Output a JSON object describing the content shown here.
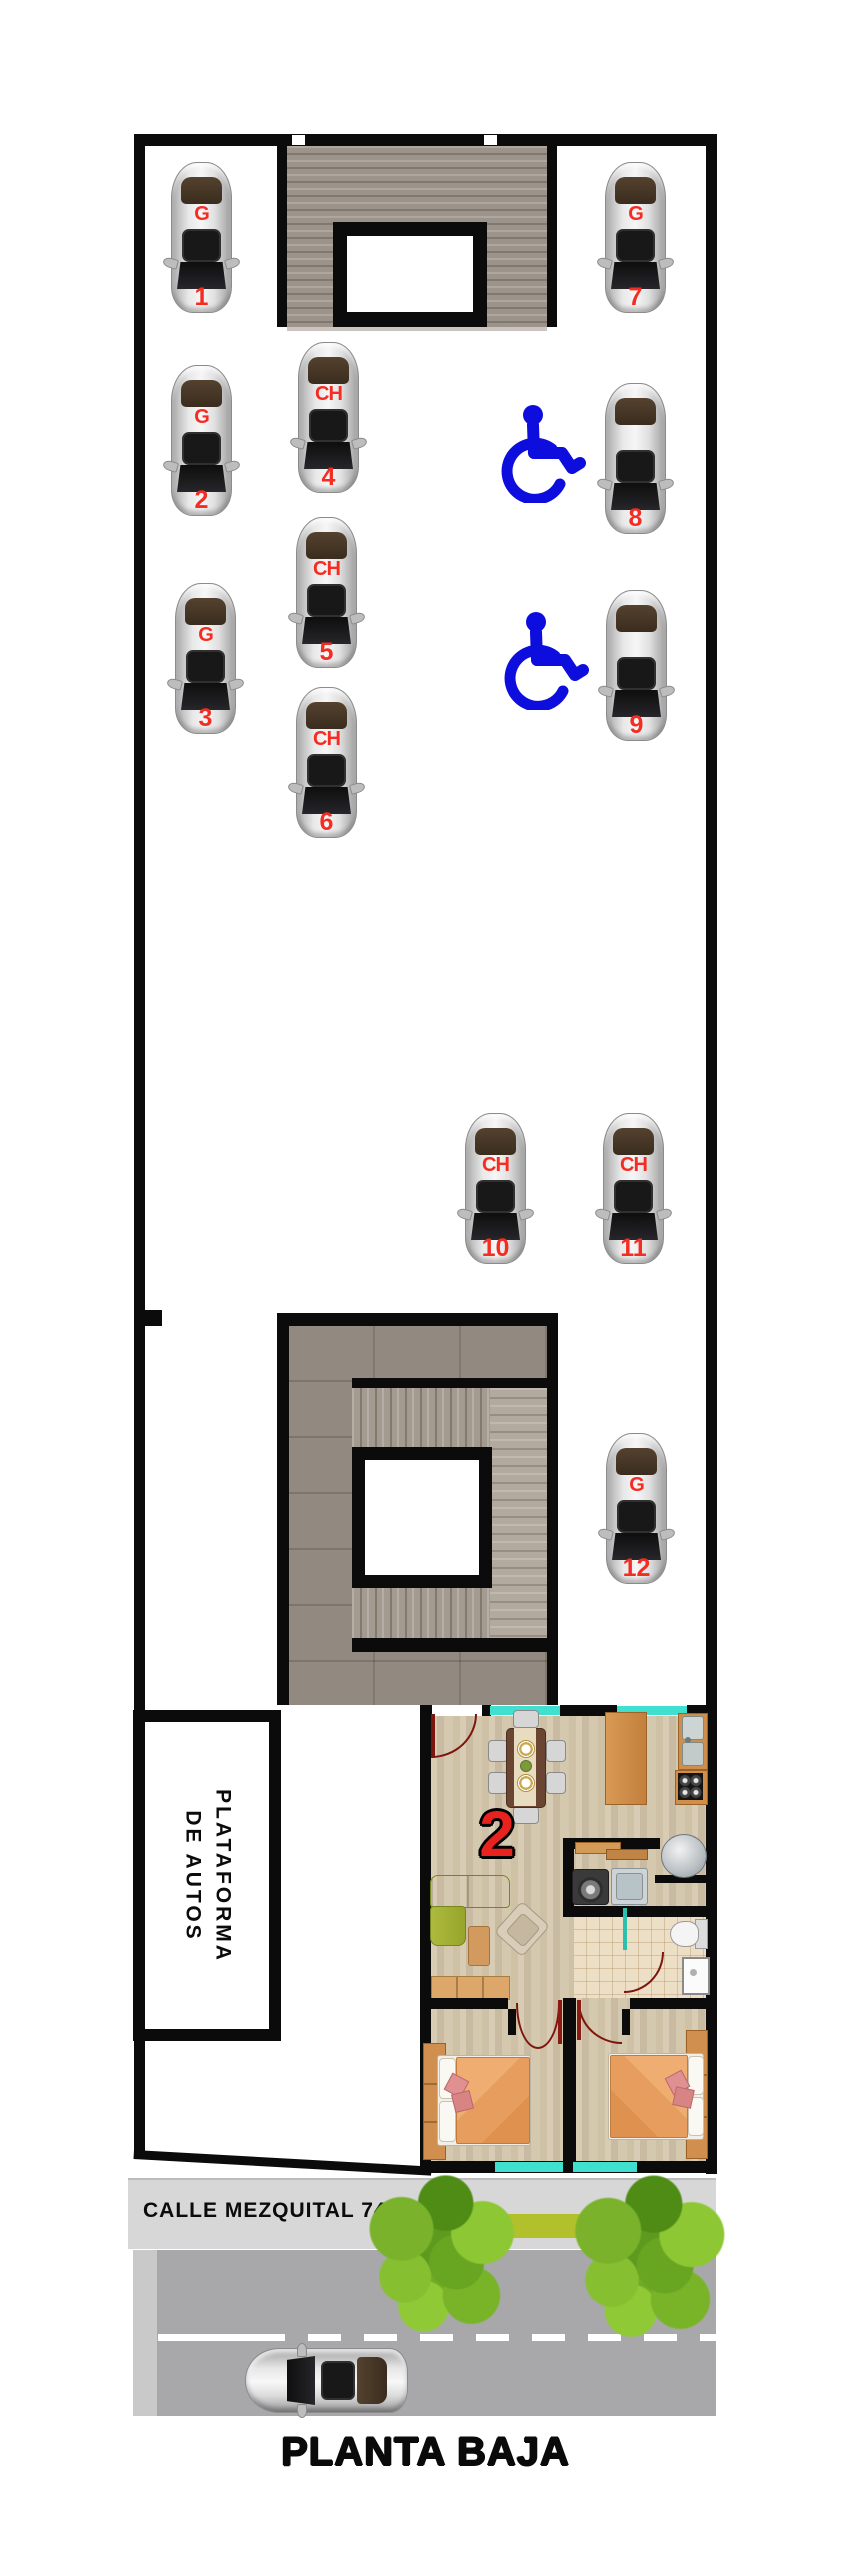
{
  "title": "PLANTA BAJA",
  "street": {
    "name_label": "CALLE MEZQUITAL 74"
  },
  "platform": {
    "line1": "PLATAFORMA",
    "line2": "DE AUTOS"
  },
  "unit": {
    "number": "2"
  },
  "parking": {
    "spot_types_legend": {
      "G": "Grande",
      "CH": "Chico"
    },
    "spots": [
      {
        "num": "1",
        "type": "G",
        "x": 168,
        "y": 162
      },
      {
        "num": "2",
        "type": "G",
        "x": 168,
        "y": 365
      },
      {
        "num": "3",
        "type": "G",
        "x": 172,
        "y": 583
      },
      {
        "num": "4",
        "type": "CH",
        "x": 295,
        "y": 342
      },
      {
        "num": "5",
        "type": "CH",
        "x": 293,
        "y": 517
      },
      {
        "num": "6",
        "type": "CH",
        "x": 293,
        "y": 687
      },
      {
        "num": "7",
        "type": "G",
        "x": 602,
        "y": 162
      },
      {
        "num": "8",
        "type": "",
        "x": 602,
        "y": 383
      },
      {
        "num": "9",
        "type": "",
        "x": 603,
        "y": 590
      },
      {
        "num": "10",
        "type": "CH",
        "x": 462,
        "y": 1113
      },
      {
        "num": "11",
        "type": "CH",
        "x": 600,
        "y": 1113
      },
      {
        "num": "12",
        "type": "G",
        "x": 603,
        "y": 1433
      }
    ],
    "handicap_icons": [
      {
        "x": 500,
        "y": 403
      },
      {
        "x": 503,
        "y": 610
      }
    ]
  },
  "street_scene": {
    "car": {
      "x": 245,
      "y": 2348
    },
    "trees": [
      {
        "cx": 442,
        "cy": 2262,
        "r": 92
      },
      {
        "cx": 650,
        "cy": 2265,
        "r": 95
      }
    ]
  },
  "colors": {
    "label_red": "#f52c22",
    "handicap_blue": "#0d0ddd",
    "window_teal": "#3fe0d0",
    "wall_black": "#0b0b0b",
    "street_gray": "#a8a8aa",
    "sidewalk_gray": "#d7d7d7",
    "lawn_green": "#b1c02b"
  }
}
